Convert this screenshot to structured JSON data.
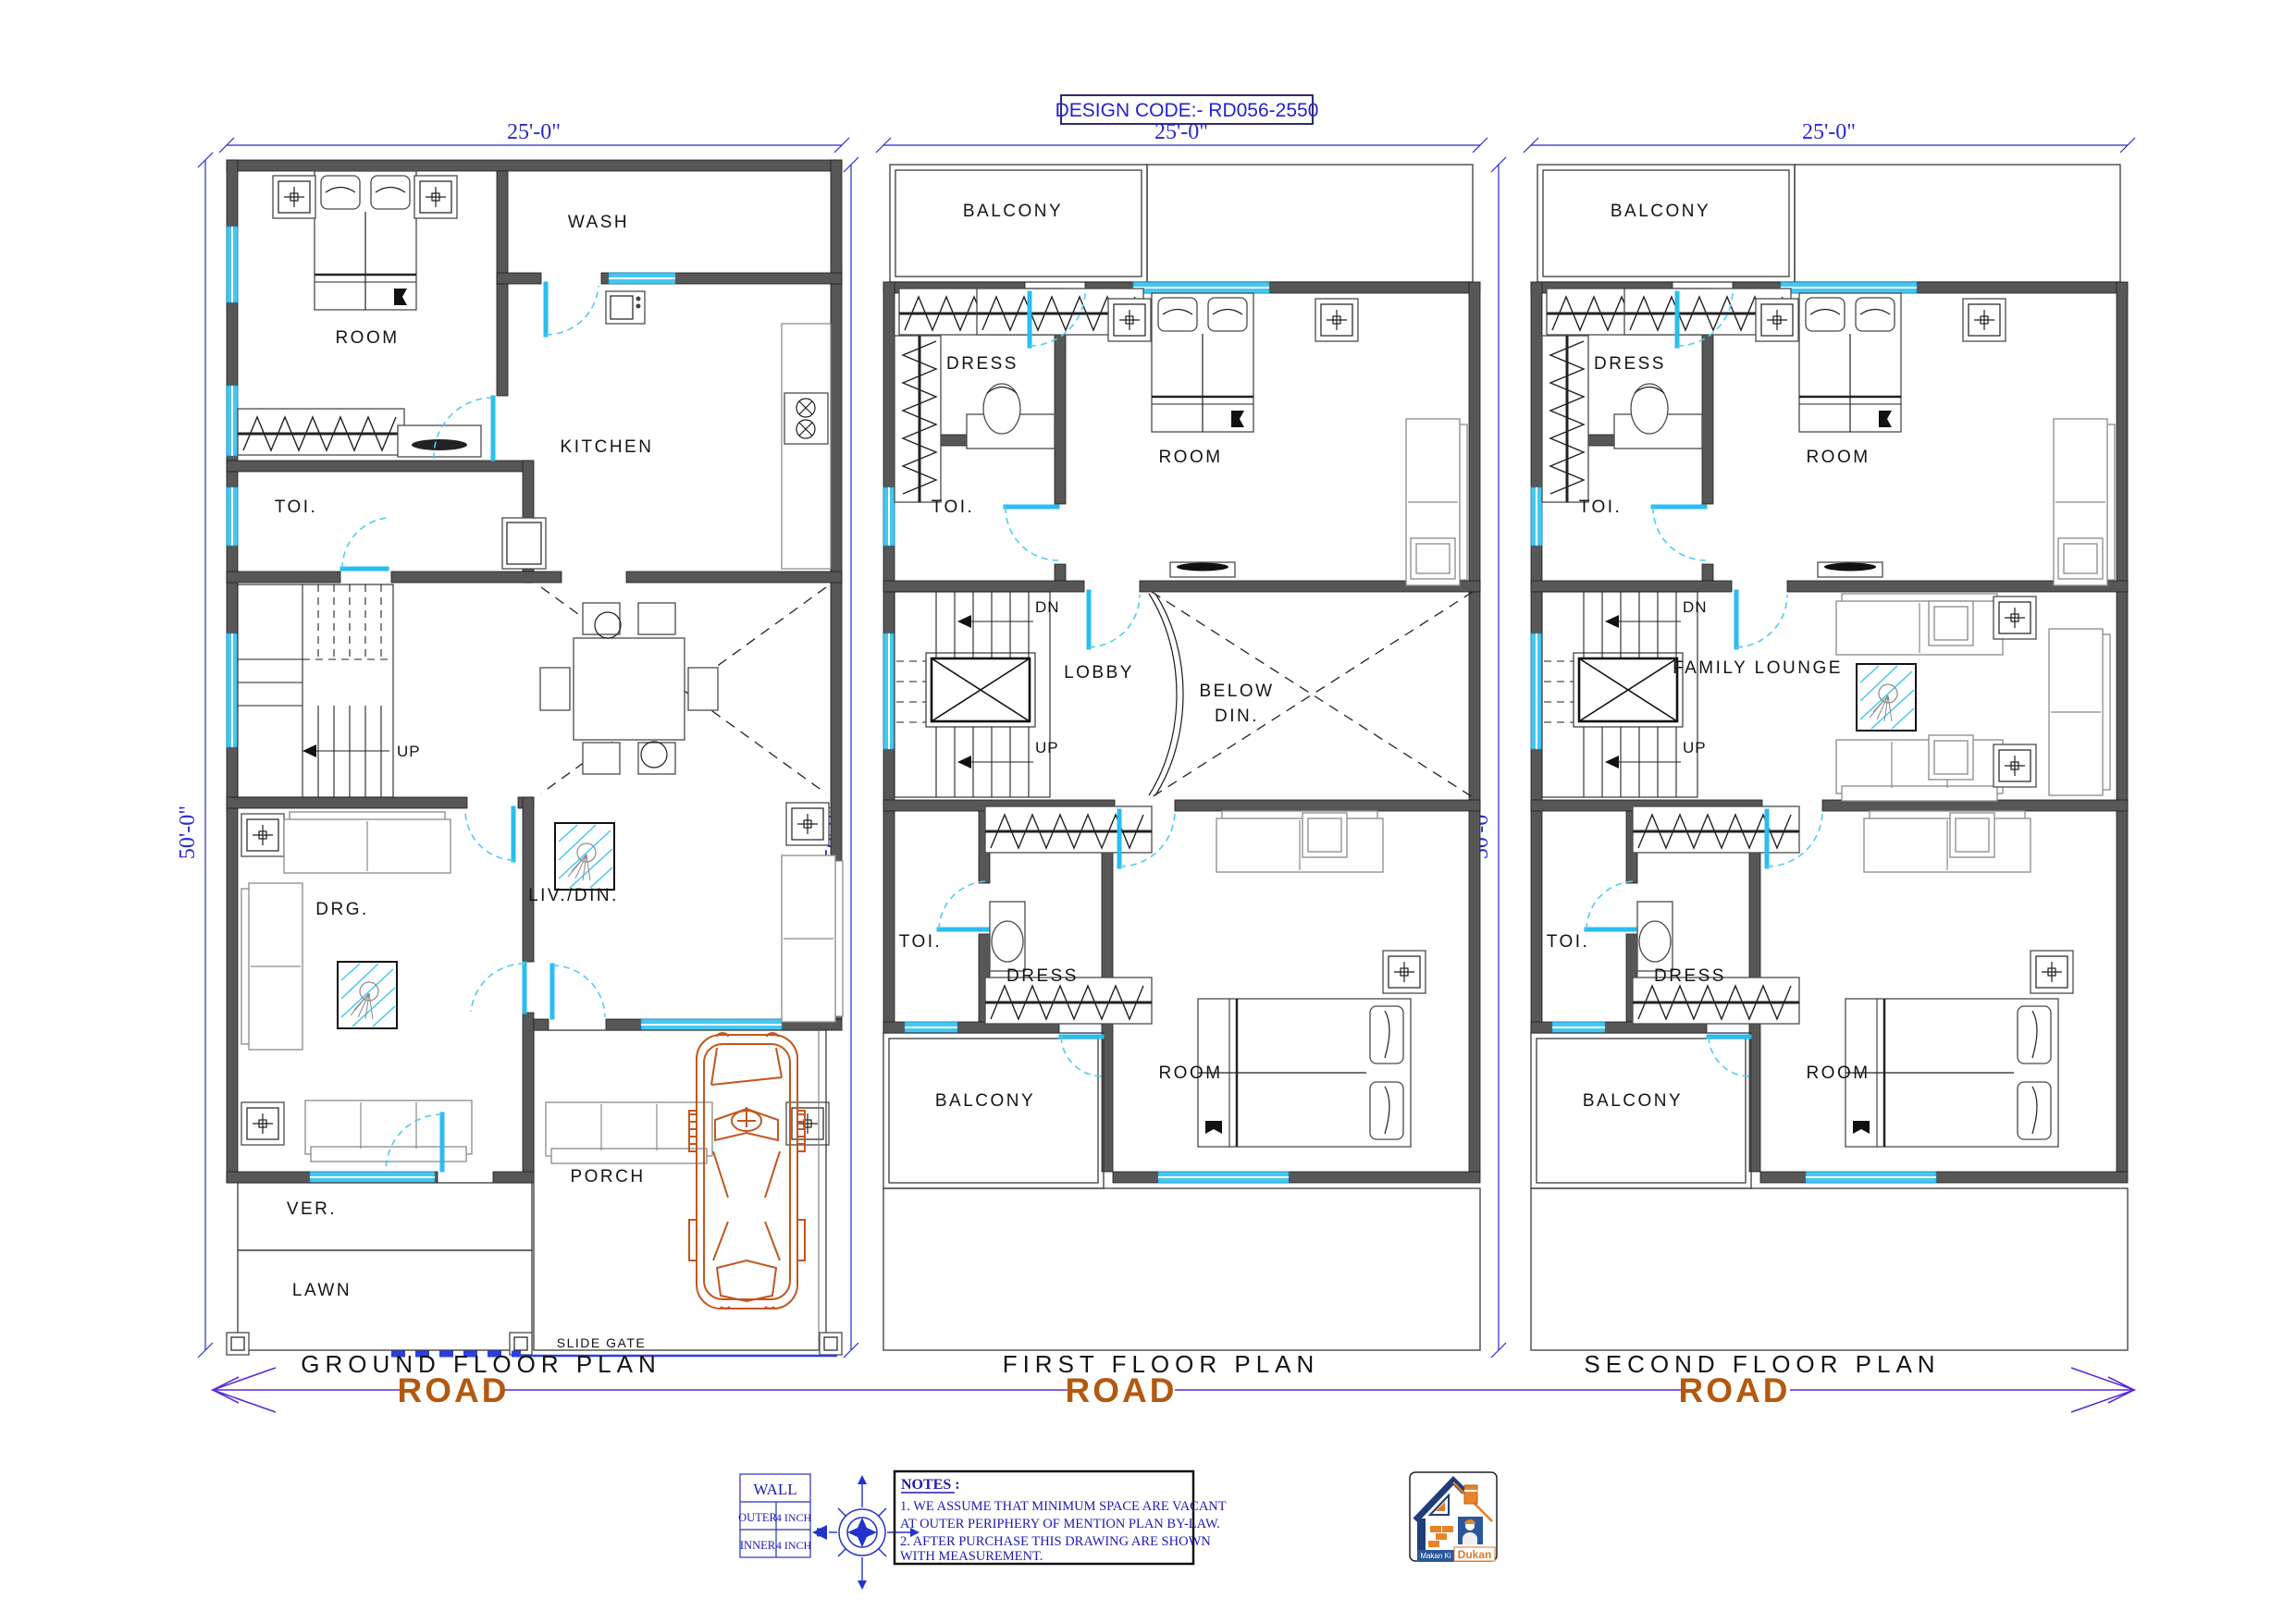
{
  "header": {
    "design_code": "DESIGN CODE:- RD056-2550"
  },
  "dims": {
    "width": "25'-0\"",
    "height": "50'-0\""
  },
  "road": "ROAD",
  "plans": {
    "ground": {
      "title": "GROUND FLOOR PLAN",
      "room": "ROOM",
      "wash": "WASH",
      "kitchen": "KITCHEN",
      "toi": "TOI.",
      "up": "UP",
      "drg": "DRG.",
      "liv_din": "LIV./DIN.",
      "ver": "VER.",
      "lawn": "LAWN",
      "porch": "PORCH",
      "slide_gate": "SLIDE GATE"
    },
    "first": {
      "title": "FIRST FLOOR PLAN",
      "balcony_top": "BALCONY",
      "dress_top": "DRESS",
      "toi_top": "TOI.",
      "room_top": "ROOM",
      "dn": "DN",
      "up": "UP",
      "lobby": "LOBBY",
      "below_din_1": "BELOW",
      "below_din_2": "DIN.",
      "toi_bottom": "TOI.",
      "dress_bottom": "DRESS",
      "balcony_bottom": "BALCONY",
      "room_bottom": "ROOM"
    },
    "second": {
      "title": "SECOND FLOOR PLAN",
      "balcony_top": "BALCONY",
      "dress_top": "DRESS",
      "toi_top": "TOI.",
      "room_top": "ROOM",
      "dn": "DN",
      "up": "UP",
      "family_lounge": "FAMILY LOUNGE",
      "toi_bottom": "TOI.",
      "dress_bottom": "DRESS",
      "balcony_bottom": "BALCONY",
      "room_bottom": "ROOM"
    }
  },
  "legend": {
    "title": "WALL",
    "rows": [
      {
        "label": "OUTER",
        "value": "4 INCH"
      },
      {
        "label": "INNER",
        "value": "4 INCH"
      }
    ]
  },
  "compass": {
    "north": "N"
  },
  "notes": {
    "heading": "NOTES :",
    "lines": [
      "1. WE ASSUME THAT MINIMUM SPACE ARE VACANT",
      "   AT OUTER PERIPHERY OF MENTION PLAN BY-LAW.",
      "2. AFTER PURCHASE THIS DRAWING ARE SHOWN",
      " WITH  MEASUREMENT."
    ]
  },
  "logo": {
    "brand_top": "Makan Ki",
    "brand_bottom": "Dukan"
  },
  "colors": {
    "wall": "#575757",
    "accent_cyan": "#29bdf0",
    "dim_blue": "#2a2ad0",
    "road_text": "#b3590f",
    "road_line": "#5a2bd6",
    "car": "#c2571f",
    "notes_blue": "#1b1bb3"
  }
}
